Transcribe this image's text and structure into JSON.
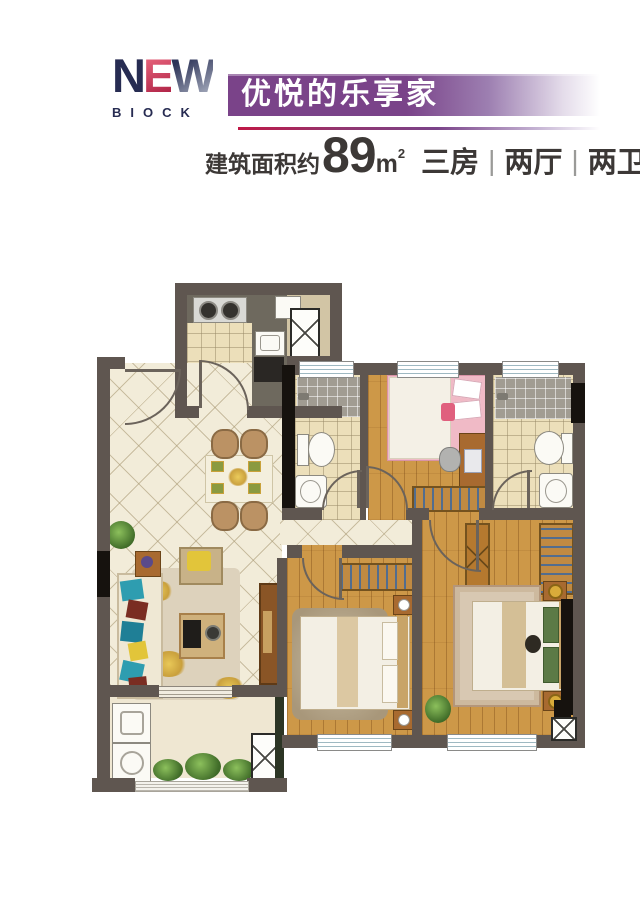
{
  "header": {
    "logo_letters": [
      "N",
      "E",
      "W"
    ],
    "logo_line2": "BIOCK",
    "banner_title": "优悦的乐享家",
    "area_prefix": "建筑面积约",
    "area_value": "89",
    "area_unit_base": "m",
    "area_unit_sup": "2",
    "spec_items": [
      "三房",
      "两厅",
      "两卫"
    ],
    "spec_separator": "|"
  },
  "palette": {
    "banner_purple": "#7a4389",
    "line_crimson": "#c01746",
    "logo_navy": "#272c52",
    "logo_red": "#c62a4e",
    "wall_gray": "#5f5650",
    "wall_black": "#16120e",
    "tile_cream": "#f2ecd9",
    "bath_tile": "#ecdfba",
    "shower_tile": "#a19c92",
    "wood_floor": "#cd9848",
    "window_blue": "#9fb9c2",
    "furniture_brown": "#b5792f",
    "bed_linen": "#f3efe4",
    "kids_pink": "#f0bac6",
    "sofa_teal": "#2e9db0",
    "accent_gold": "#d9ab3a"
  },
  "floorplan": {
    "rooms": [
      "kitchen",
      "flue-shaft",
      "foyer-dining",
      "living-room",
      "bathroom-1",
      "kids-bedroom",
      "bathroom-2",
      "hallway",
      "bedroom-2",
      "master-bedroom",
      "balcony"
    ],
    "features": [
      "gas-stove",
      "kettle",
      "kitchen-sink",
      "base-cabinet",
      "shower-area",
      "toilet",
      "wash-basin",
      "kids-bed",
      "desk",
      "chair",
      "wardrobe",
      "dining-table",
      "dining-chairs",
      "sofa",
      "coffee-table",
      "armchair",
      "side-table",
      "tv-cabinet",
      "double-bed",
      "nightstand",
      "table-lamp",
      "dresser",
      "area-rug",
      "washing-machine",
      "planter",
      "window",
      "door-swing"
    ]
  }
}
